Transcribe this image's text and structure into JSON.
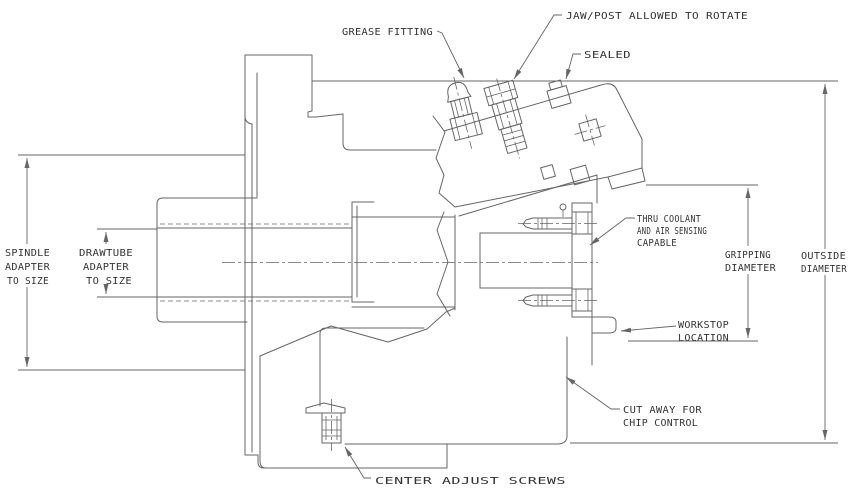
{
  "drawing_title": "CHUCK CROSS SECTION",
  "colors": {
    "line_color": "#666666",
    "text_color": "#333333",
    "background": "#ffffff"
  },
  "callouts": {
    "grease_fitting": {
      "label": "GREASE FITTING"
    },
    "jaw_post": {
      "label": "JAW/POST ALLOWED TO ROTATE"
    },
    "sealed": {
      "label": "SEALED"
    },
    "thru_coolant": {
      "lines": [
        "THRU COOLANT",
        "AND AIR SENSING",
        "CAPABLE"
      ]
    },
    "workstop": {
      "lines": [
        "WORKSTOP",
        "LOCATION"
      ]
    },
    "cut_away": {
      "lines": [
        "CUT AWAY FOR",
        "CHIP CONTROL"
      ]
    },
    "center_adjust": {
      "label": "CENTER ADJUST SCREWS"
    }
  },
  "dimensions": {
    "spindle_adapter": {
      "lines": [
        "SPINDLE",
        "ADAPTER",
        "TO SIZE"
      ]
    },
    "drawtube_adapter": {
      "lines": [
        "DRAWTUBE",
        "ADAPTER",
        "TO SIZE"
      ]
    },
    "gripping_diameter": {
      "lines": [
        "GRIPPING",
        "DIAMETER"
      ]
    },
    "outside_diameter": {
      "lines": [
        "OUTSIDE",
        "DIAMETER"
      ]
    }
  }
}
